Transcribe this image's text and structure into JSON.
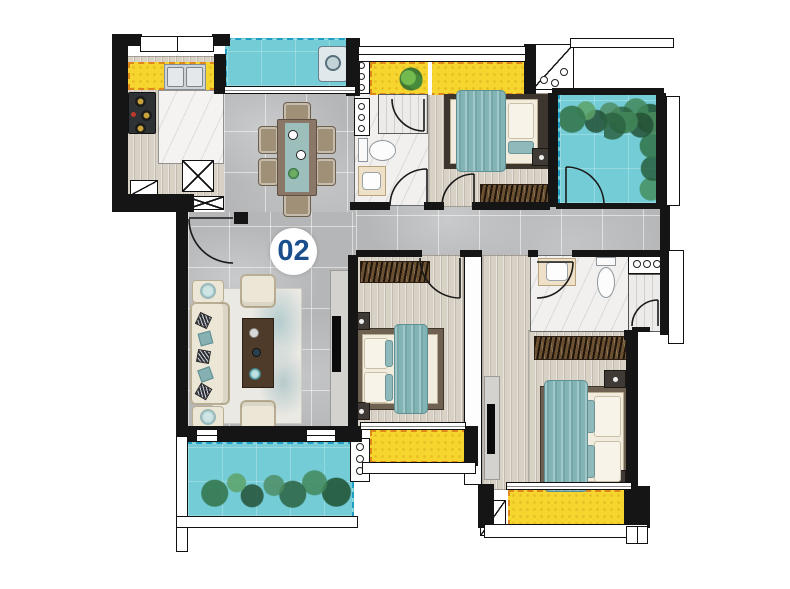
{
  "unit": {
    "label": "02"
  },
  "colors": {
    "wall": "#151515",
    "tile": "#b5b6b8",
    "wood": "#d8d1c5",
    "marble": "#f1f0ee",
    "yellow": "#f6d62e",
    "yellow_border": "#e0871c",
    "teal": "#74ccd7",
    "teal_border": "#1f9dc5",
    "bed_teal": "#82b4b6",
    "cream": "#ece6d6",
    "dark_table": "#4e3b29",
    "label_blue": "#1b4e8c"
  },
  "icons": [
    "dining-table-icon",
    "sofa-icon",
    "coffee-table-icon",
    "tv-icon",
    "bed-icon",
    "wardrobe-icon",
    "toilet-icon",
    "sink-icon",
    "shower-icon",
    "stove-icon",
    "kitchen-sink-icon",
    "washing-machine-icon",
    "plant-icon",
    "door-arc-icon",
    "duct-x-icon",
    "ac-platform-icon"
  ]
}
